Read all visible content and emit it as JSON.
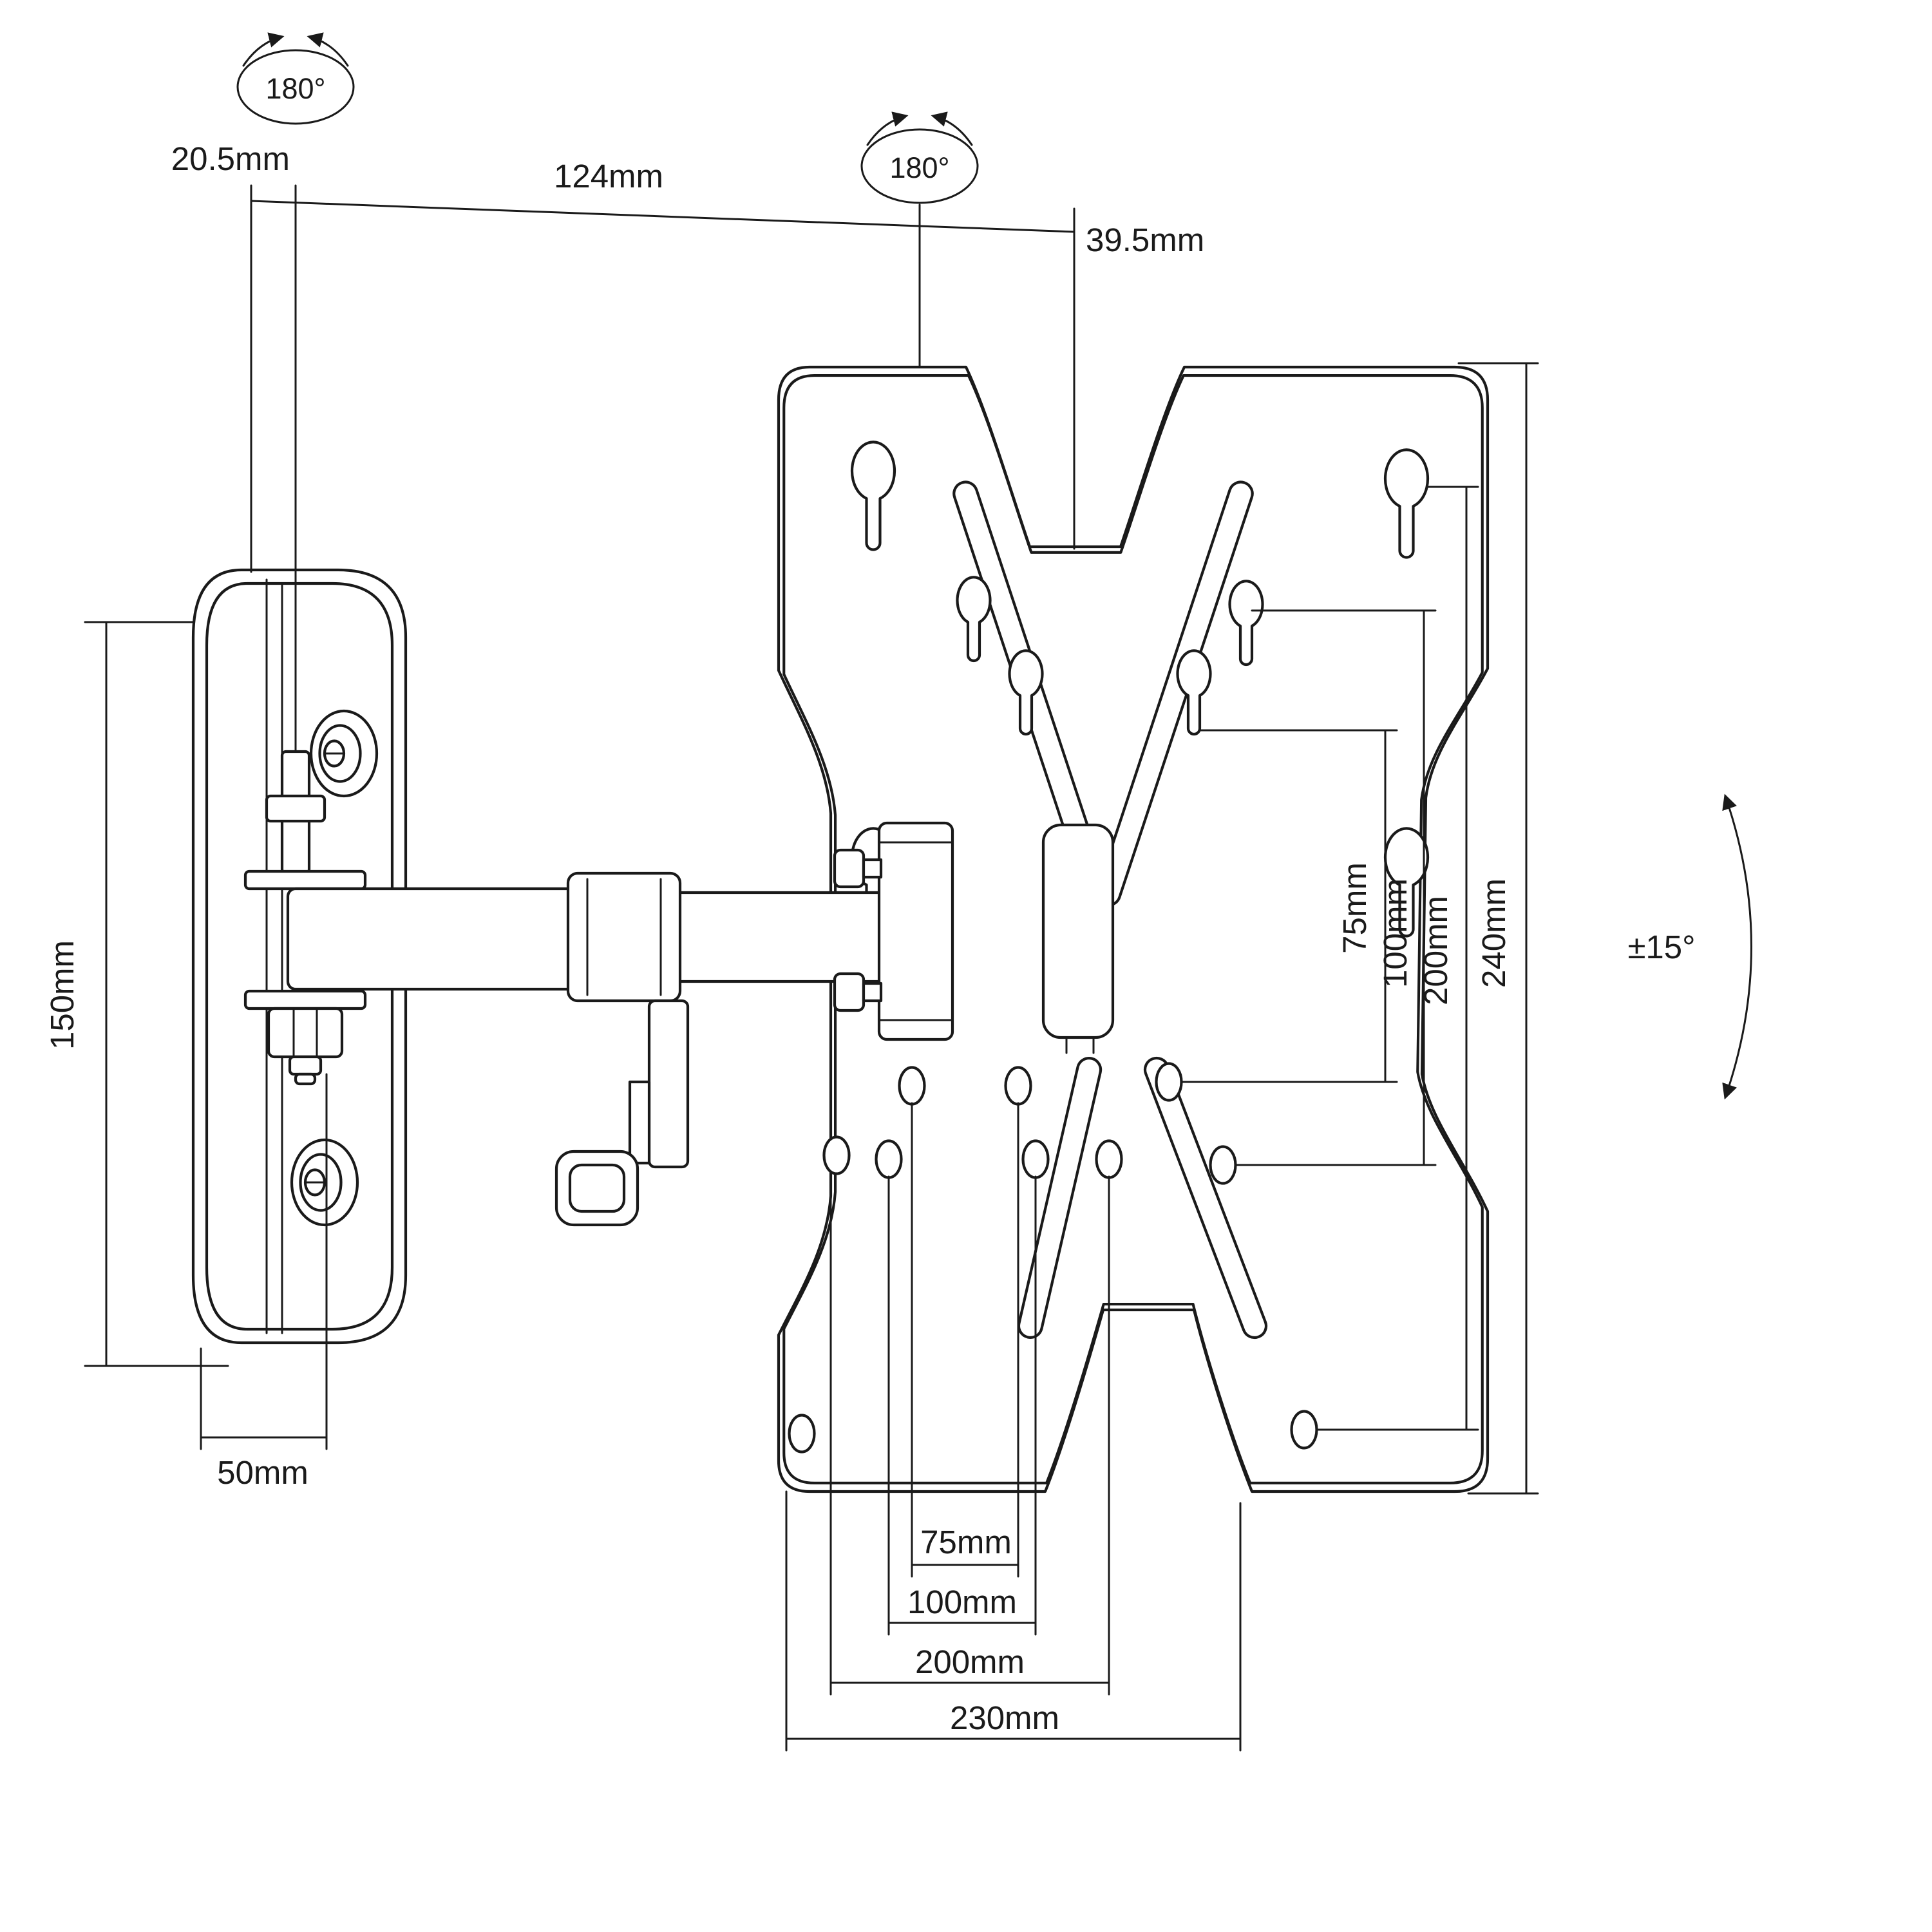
{
  "drawing": {
    "type": "technical-dimension-diagram",
    "subject": "Articulating TV wall mount bracket",
    "background_color": "#ffffff",
    "line_color": "#1a1a1a"
  },
  "annotations": {
    "swivel_wall_joint": {
      "label": "180°"
    },
    "swivel_plate_joint": {
      "label": "180°"
    },
    "wall_offset": {
      "label": "20.5mm"
    },
    "arm_reach": {
      "label": "124mm"
    },
    "plate_offset": {
      "label": "39.5mm"
    },
    "wall_plate_height": {
      "label": "150mm"
    },
    "wall_plate_width": {
      "label": "50mm"
    },
    "tilt_range": {
      "label": "±15°"
    },
    "vesa_vertical": {
      "v75": {
        "label": "75mm"
      },
      "v100": {
        "label": "100mm"
      },
      "v200": {
        "label": "200mm"
      },
      "v240": {
        "label": "240mm"
      }
    },
    "vesa_horizontal": {
      "h75": {
        "label": "75mm"
      },
      "h100": {
        "label": "100mm"
      },
      "h200": {
        "label": "200mm"
      },
      "h230": {
        "label": "230mm"
      }
    }
  }
}
